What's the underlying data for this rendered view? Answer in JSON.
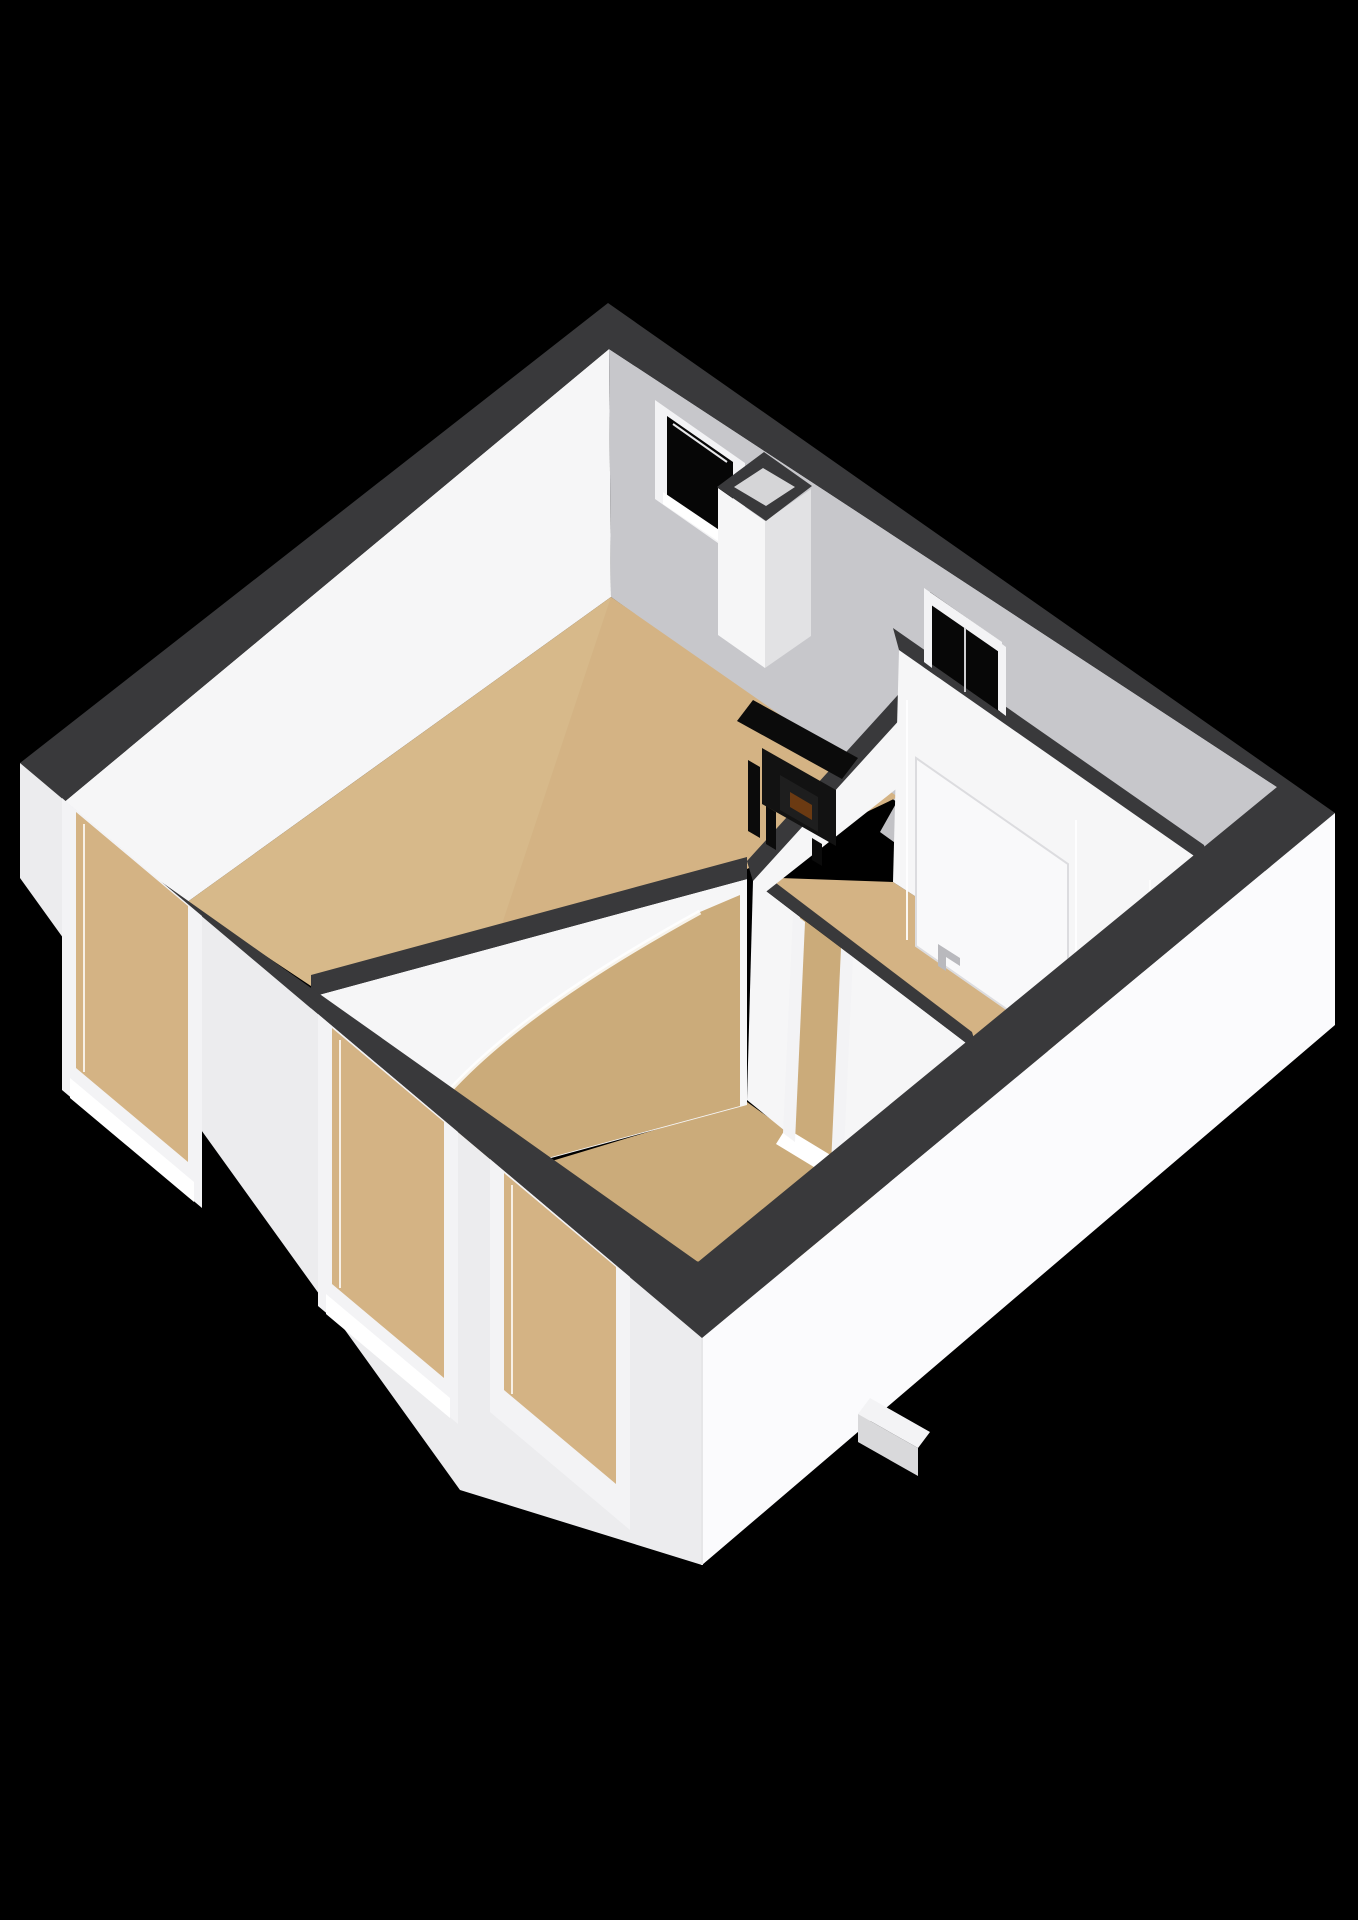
{
  "meta": {
    "description": "3D isometric cutaway floor plan render of a small apartment, viewed from above on a black background",
    "image_type": "3d-floorplan-render"
  },
  "colors": {
    "background": "#000000",
    "wall_top": "#39393b",
    "wall_white": "#f6f6f7",
    "wall_white_dim": "#ededef",
    "wall_gray": "#c7c7cb",
    "wall_exterior_left": "#ececee",
    "wall_exterior_right": "#fbfbfd",
    "floor_wood": "#d4b384",
    "floor_wood_dark": "#cbab7a",
    "floor_gray": "#c2c2c6",
    "window_void": "#060606",
    "door_void": "#070707",
    "frame_white": "#f3f3f5",
    "sill_white": "#ffffff",
    "chimney_side": "#e2e2e4",
    "chimney_inner": "#d5d5d7",
    "stove_black": "#121212",
    "stove_dark": "#0b0b0b",
    "stove_glow": "#6b3a12",
    "step_side": "#d9d9db"
  },
  "rooms": [
    {
      "id": "living-room",
      "floor": "wood",
      "features": [
        "back wall window",
        "chimney shaft",
        "black wood stove",
        "arched opening"
      ]
    },
    {
      "id": "front-room",
      "floor": "wood",
      "features": [
        "two front windows",
        "arched opening",
        "doorway with threshold"
      ]
    },
    {
      "id": "hallway",
      "floor": "wood",
      "features": [
        "interior door with handle",
        "doorway to front room"
      ]
    },
    {
      "id": "entrance-hall",
      "floor": "gray",
      "features": [
        "entrance door opening"
      ]
    }
  ],
  "elements": {
    "windows_front_wall": 3,
    "windows_back_wall": 1,
    "exterior_door_openings": 1,
    "interior_doors": 2,
    "chimney_shafts": 1,
    "stoves": 1,
    "arched_openings": 1,
    "exterior_steps": 1
  }
}
